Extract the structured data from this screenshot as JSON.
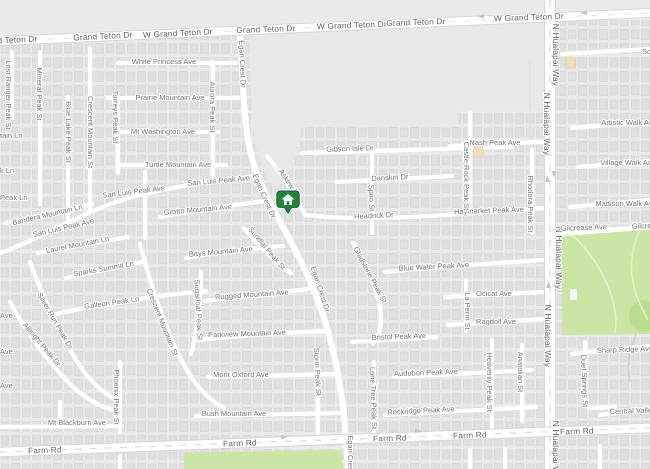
{
  "map": {
    "type": "street-map",
    "marker": {
      "name": "property-location-pin",
      "glyph": "house",
      "fill": "#26843a",
      "border": "#145c26",
      "halo": "#ffffff"
    },
    "colors": {
      "land": "#eaeaea",
      "vacant_parcel": "#e7e8e8",
      "road": "#ffffff",
      "road_casing": "#d7d7d7",
      "park": "#cbe6a4",
      "park_accent": "#b7d98b",
      "building": "#e0e0e0",
      "building_outline": "#d3d3d3",
      "highlight_building": "#f0debb",
      "street_label": "#757575",
      "major_label": "#5f6368"
    }
  },
  "labels": [
    "Grand Teton Dr",
    "Grand Teton Dr",
    "W Grand Teton Dr",
    "Grand Teton Dr",
    "W Grand Teton Dr",
    "Grand Teton Dr",
    "W Grand Teton Dr",
    "N Hualapai Way",
    "N Hualapai Way",
    "N Hualapai Way",
    "N Hualapai Way",
    "N Hualapai Way",
    "Farm Rd",
    "Farm Rd",
    "Farm Rd",
    "Farm Rd",
    "Farm Rd",
    "White Princess Ave",
    "Prairie Mountain Ave",
    "Mt Washington Ave",
    "Turtle Mountain Ave",
    "San Luis Peak Ave",
    "San Luis Peak Ave",
    "San Luis Peak Ave",
    "Grotto Mountain Ave",
    "Bays Mountain Ave",
    "Rugged Mountain Ave",
    "Parkview Mountain Ave",
    "Mont Oxford Ave",
    "Bush Mountain Ave",
    "Mt Blackburn Ave",
    "Laurel Mountain Ln",
    "Sparks Summit Ln",
    "Galleon Peak Ln",
    "Bandera Mountain Ln",
    "Lost Ranger Peak St",
    "Mineral Peak St",
    "Blue Lake Peak St",
    "Crescent Mountain St",
    "Torreys Peak St",
    "Aurora Peak St",
    "Egan Crest Dr",
    "Egan Crest Dr",
    "Egan Crest Dr",
    "Egan Crest Dr",
    "Askew Pl",
    "Silver Run Peak Dr",
    "Albright Peak Dr",
    "Crescent Mountain St",
    "Sugarloaf Peak St",
    "Sundial Peak St",
    "Phoenix Peak St",
    "Storm Peak St",
    "Lone Tree Peak St",
    "Gladstone Peak St",
    "Gibson Isle Dr",
    "Danskin Dr",
    "Headrick Dr",
    "Spiro St",
    "Nash Peak Ave",
    "Haymarket Peak Ave",
    "Castle Rock Peak St",
    "Rhodora Peak St",
    "Blue Water Peak Ave",
    "Ocicat Ave",
    "Ragdoll Ave",
    "La Perm St",
    "Bristol Peak Ave",
    "Audubon Peak Ave",
    "Rockridge Peak Ave",
    "Heavenly Peak St",
    "Anatolian St",
    "Artistic Walk Ave",
    "Village Walk Ave",
    "Madison Walk Ave",
    "Gilcrease Ave",
    "Gilcrease Ave",
    "Sharp Ridge Ave",
    "Central Valley Ave",
    "Duet Springs St",
    "Sce",
    "Ave",
    "Ave",
    "Ave",
    "tain Ln",
    "k Ln",
    "Peak Ln"
  ]
}
